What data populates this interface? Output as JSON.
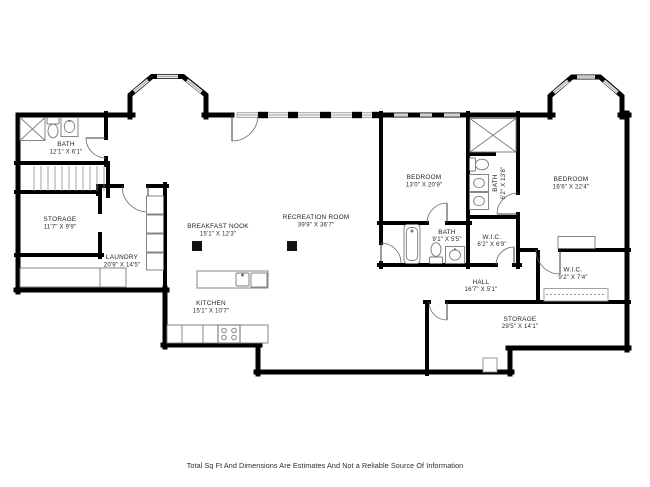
{
  "title": "Basement Floor Plan",
  "disclaimer": "Total Sq Ft And Dimensions Are Estimates And Not a Reliable Source Of Information",
  "colors": {
    "wall": "#000000",
    "window_fill": "#efefef",
    "window_edge": "#8f8f8f",
    "fixture_outline": "#7a7a7a",
    "label_text": "#1d1d1d"
  },
  "rooms": [
    {
      "id": "bath-upper-left",
      "name": "BATH",
      "dims": "12'1\" X 6'1\""
    },
    {
      "id": "storage-upper-left",
      "name": "STORAGE",
      "dims": "11'7\" X 9'9\""
    },
    {
      "id": "laundry",
      "name": "LAUNDRY",
      "dims": "20'9\" X 14'5\""
    },
    {
      "id": "breakfast-nook",
      "name": "BREAKFAST NOOK",
      "dims": "15'1\" X 12'3\""
    },
    {
      "id": "recreation-room",
      "name": "RECREATION ROOM",
      "dims": "39'9\" X 36'7\""
    },
    {
      "id": "kitchen",
      "name": "KITCHEN",
      "dims": "15'1\" X 10'7\""
    },
    {
      "id": "bedroom-left",
      "name": "BEDROOM",
      "dims": "13'0\" X 20'9\""
    },
    {
      "id": "bath-ensuite",
      "name": "BATH",
      "dims": "6'2\" X 13'8\""
    },
    {
      "id": "bedroom-right",
      "name": "BEDROOM",
      "dims": "16'6\" X 22'4\""
    },
    {
      "id": "bath-middle",
      "name": "BATH",
      "dims": "9'1\" X 5'5\""
    },
    {
      "id": "wic-left",
      "name": "W.I.C.",
      "dims": "6'2\" X 6'9\""
    },
    {
      "id": "wic-right",
      "name": "W.I.C.",
      "dims": "9'2\" X 7'4\""
    },
    {
      "id": "hall",
      "name": "HALL",
      "dims": "16'7\" X 5'1\""
    },
    {
      "id": "storage-lower-right",
      "name": "STORAGE",
      "dims": "29'5\" X 14'1\""
    }
  ]
}
